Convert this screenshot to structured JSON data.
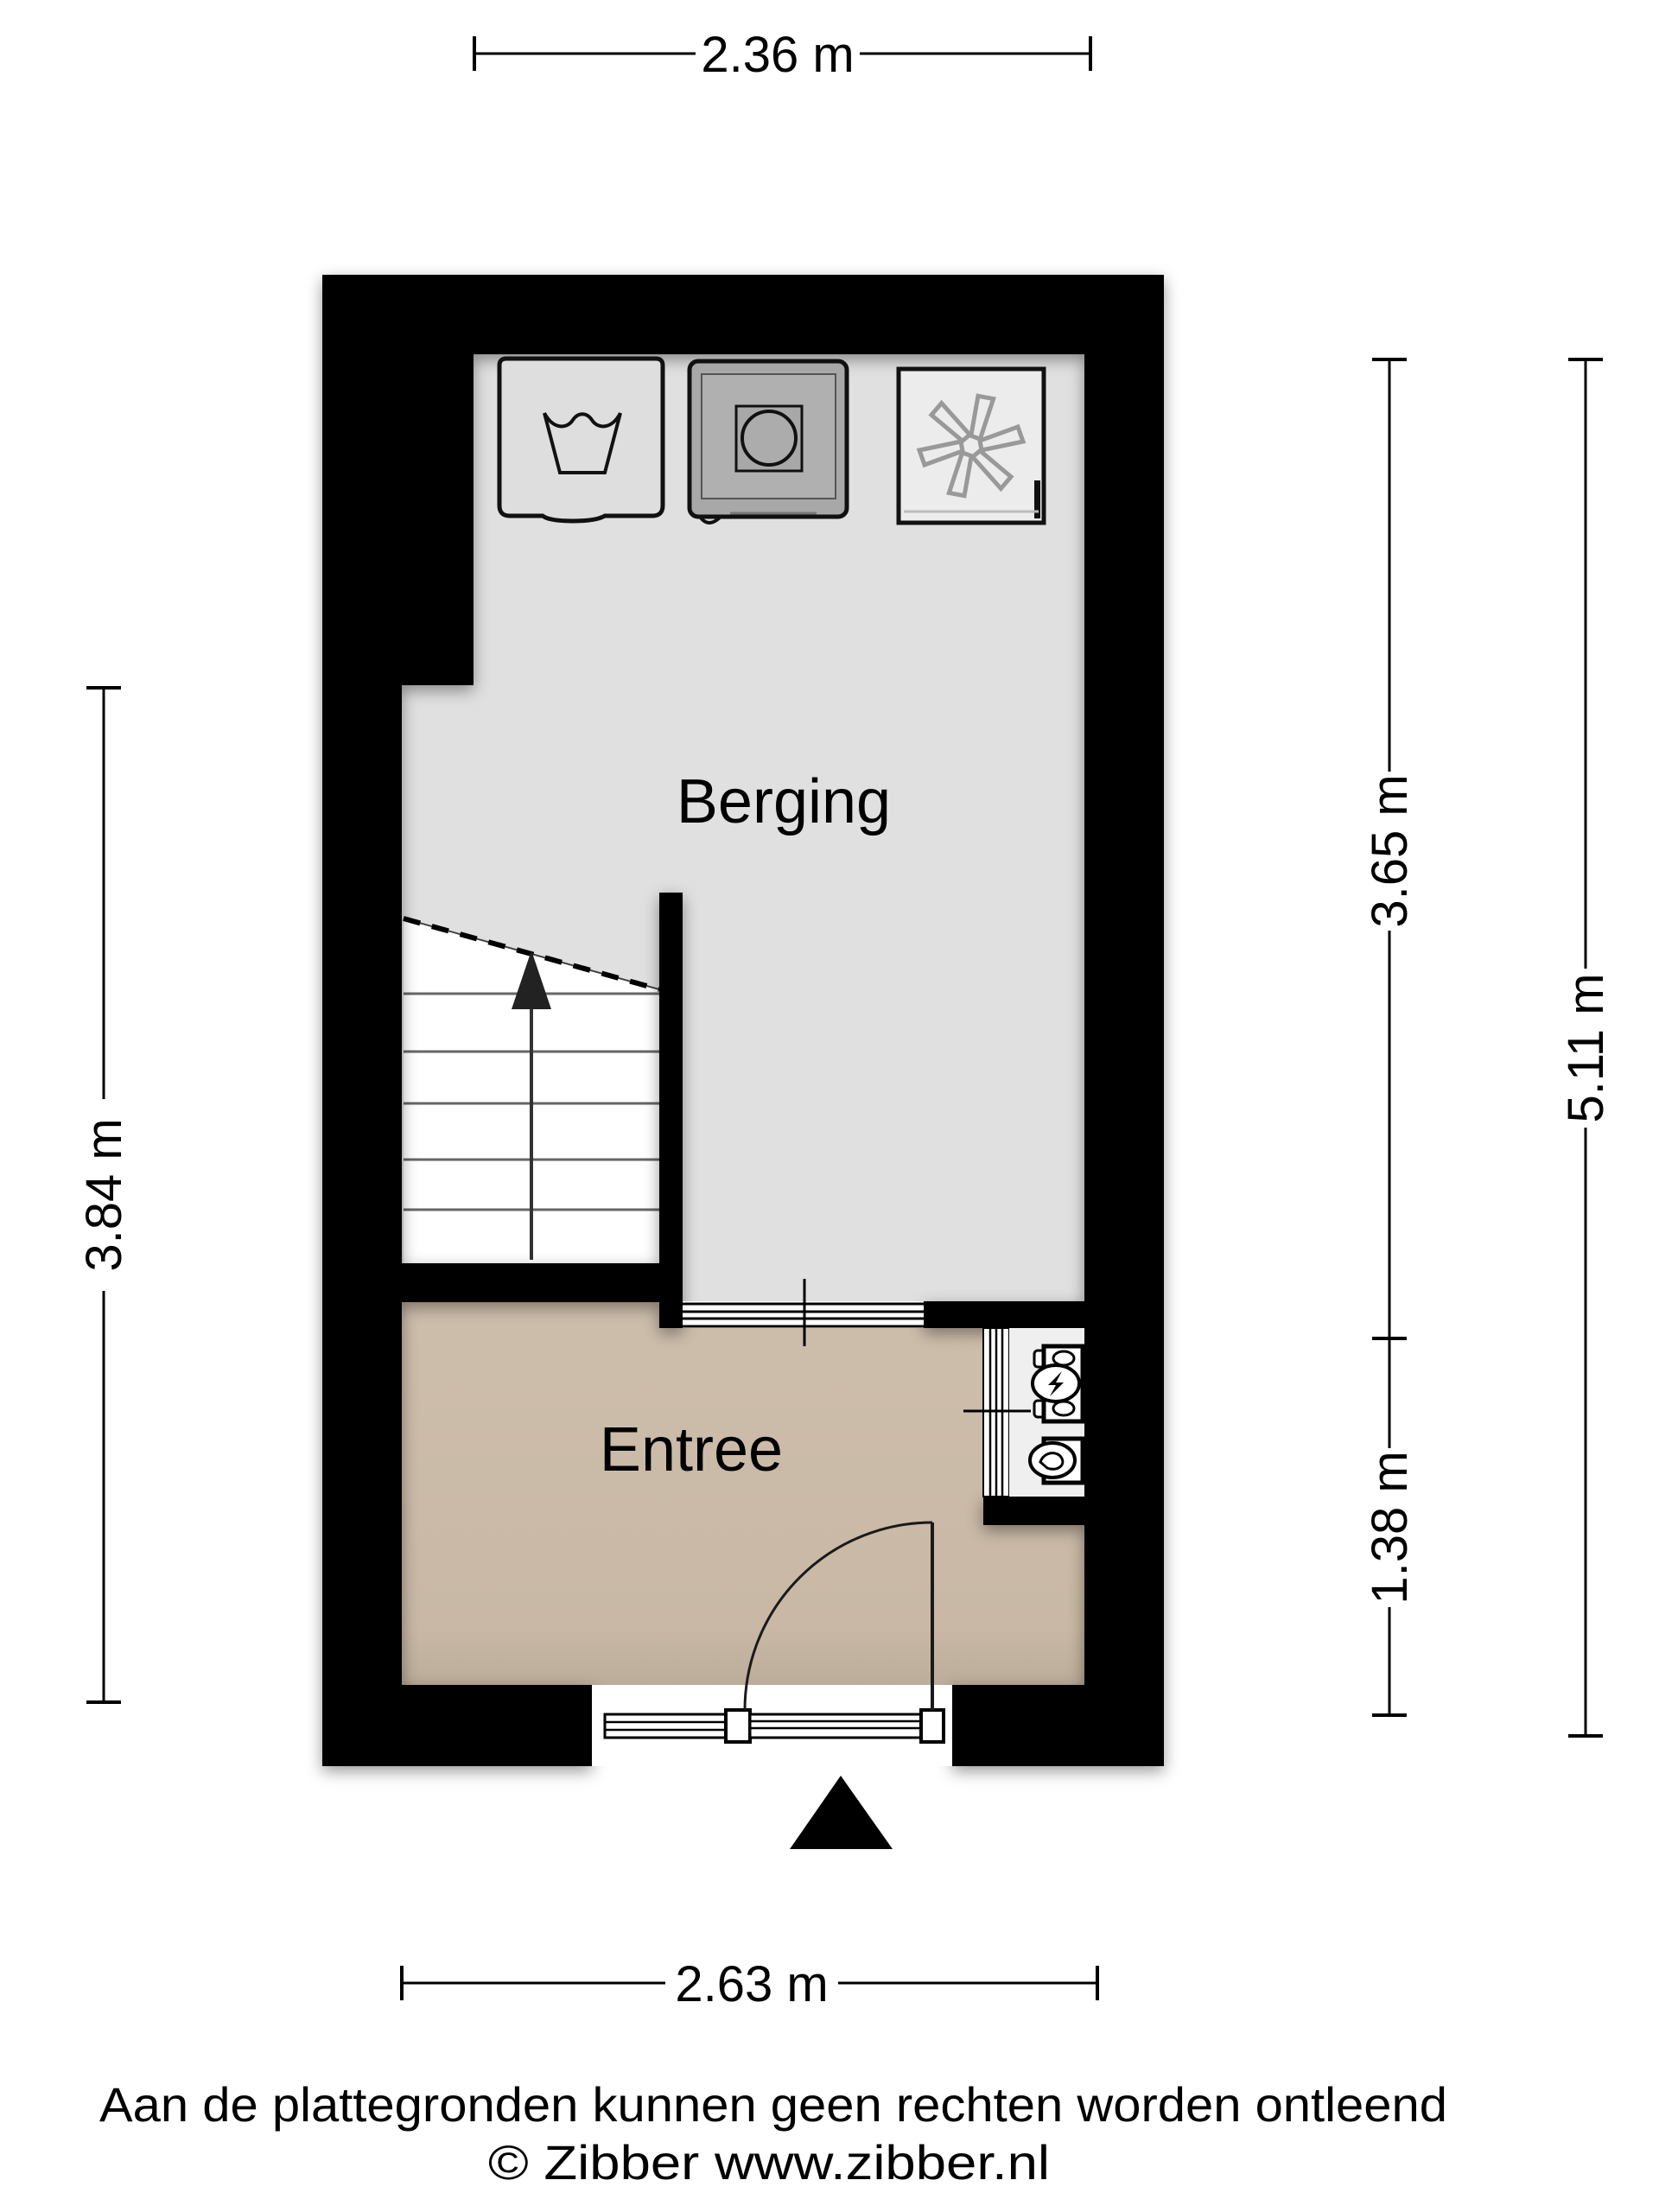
{
  "plan": {
    "labels": {
      "berging": "Berging",
      "entree": "Entree"
    },
    "dimensions": {
      "top": "2.36 m",
      "bottom": "2.63 m",
      "left": "3.84 m",
      "right_upper": "3.65 m",
      "right_lower": "1.38 m",
      "right_total": "5.11 m"
    },
    "icons": [
      "washing-machine-icon",
      "tumble-dryer-icon",
      "ventilation-unit-icon",
      "stairs-up-arrow-icon",
      "door-swing-icon",
      "electricity-meter-icon",
      "water-meter-icon",
      "entrance-marker-icon"
    ],
    "colors": {
      "wall": "#000000",
      "berging_floor": "#e0e0e0",
      "entree_floor": "#c8b8a5",
      "stairs": "#ffffff",
      "meter_niche": "#efefef",
      "dryer_body": "#a8a8a8",
      "appliance_body": "#e3e3e3"
    }
  },
  "footer": {
    "disclaimer": "Aan de plattegronden kunnen geen rechten worden ontleend",
    "credit": "© Zibber www.zibber.nl"
  }
}
